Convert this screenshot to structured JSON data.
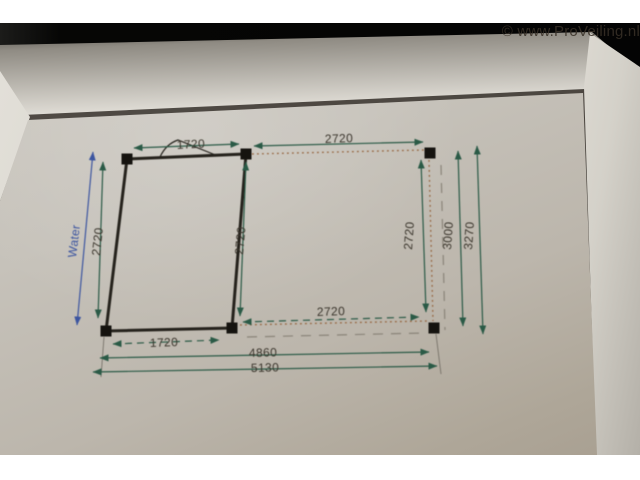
{
  "watermark": "© www.ProVeiling.nl",
  "drawing": {
    "type": "dimensioned floor plan of a canopy / garden structure in an aluminium frame",
    "labels": {
      "water": "Water",
      "top_left_width": "1720",
      "top_right_width": "2720",
      "left_height": "2720",
      "middle_height": "2720",
      "right_inner_height": "2720",
      "right_height_roof": "3000",
      "right_height_total": "3270",
      "bottom_right_width": "2720",
      "bottom_left_width": "1720",
      "bottom_span": "4860",
      "bottom_total": "5130"
    },
    "colors": {
      "dimension_line": "#2a5a46",
      "water_line": "#3c55a0",
      "structure": "#25221c",
      "dashed_brown": "#96653f",
      "dashed_gray": "#8a8479",
      "paper": "#c4c0b8",
      "frame_silver": "#d6d3cc"
    }
  }
}
